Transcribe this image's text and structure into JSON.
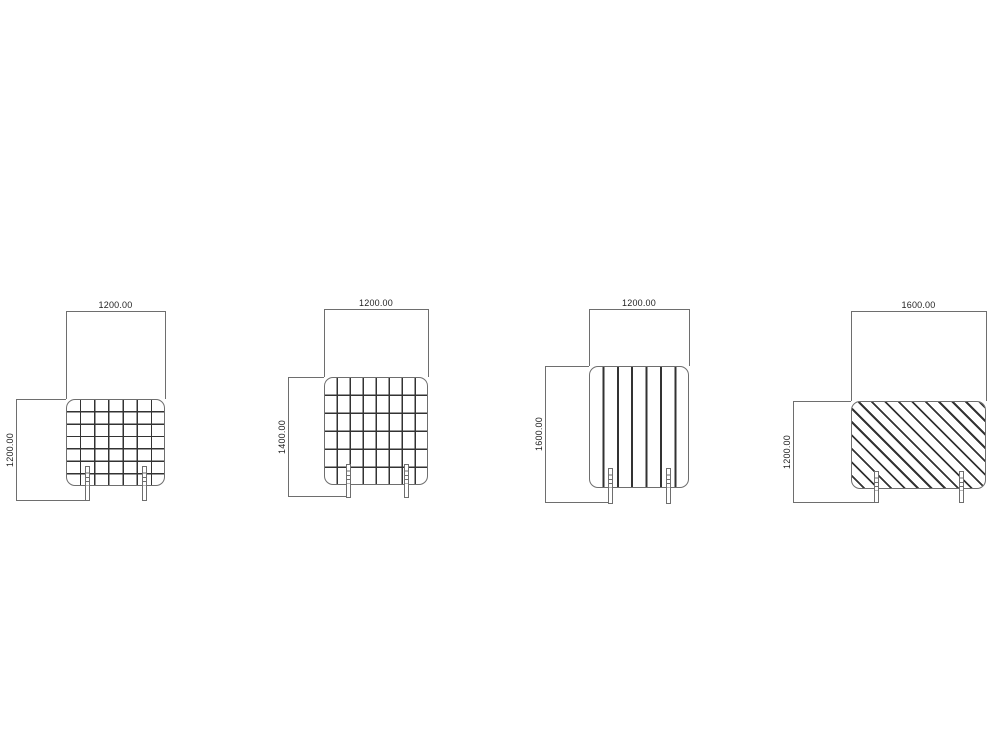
{
  "drawing": {
    "background_color": "#ffffff",
    "line_color": "#6e6e6e",
    "pattern_color": "#333333",
    "text_color": "#1f1f1f",
    "panels": [
      {
        "name": "mesh-screen-1200x1200",
        "pattern": "wire-mesh-grid",
        "width_label": "1200.00",
        "height_label": "1200.00"
      },
      {
        "name": "mesh-screen-1200x1400",
        "pattern": "wire-mesh-grid",
        "width_label": "1200.00",
        "height_label": "1400.00"
      },
      {
        "name": "slat-screen-1200x1600",
        "pattern": "vertical-slats",
        "width_label": "1200.00",
        "height_label": "1600.00"
      },
      {
        "name": "hatch-screen-1600x1200",
        "pattern": "diagonal-hatch",
        "width_label": "1600.00",
        "height_label": "1200.00"
      }
    ]
  }
}
